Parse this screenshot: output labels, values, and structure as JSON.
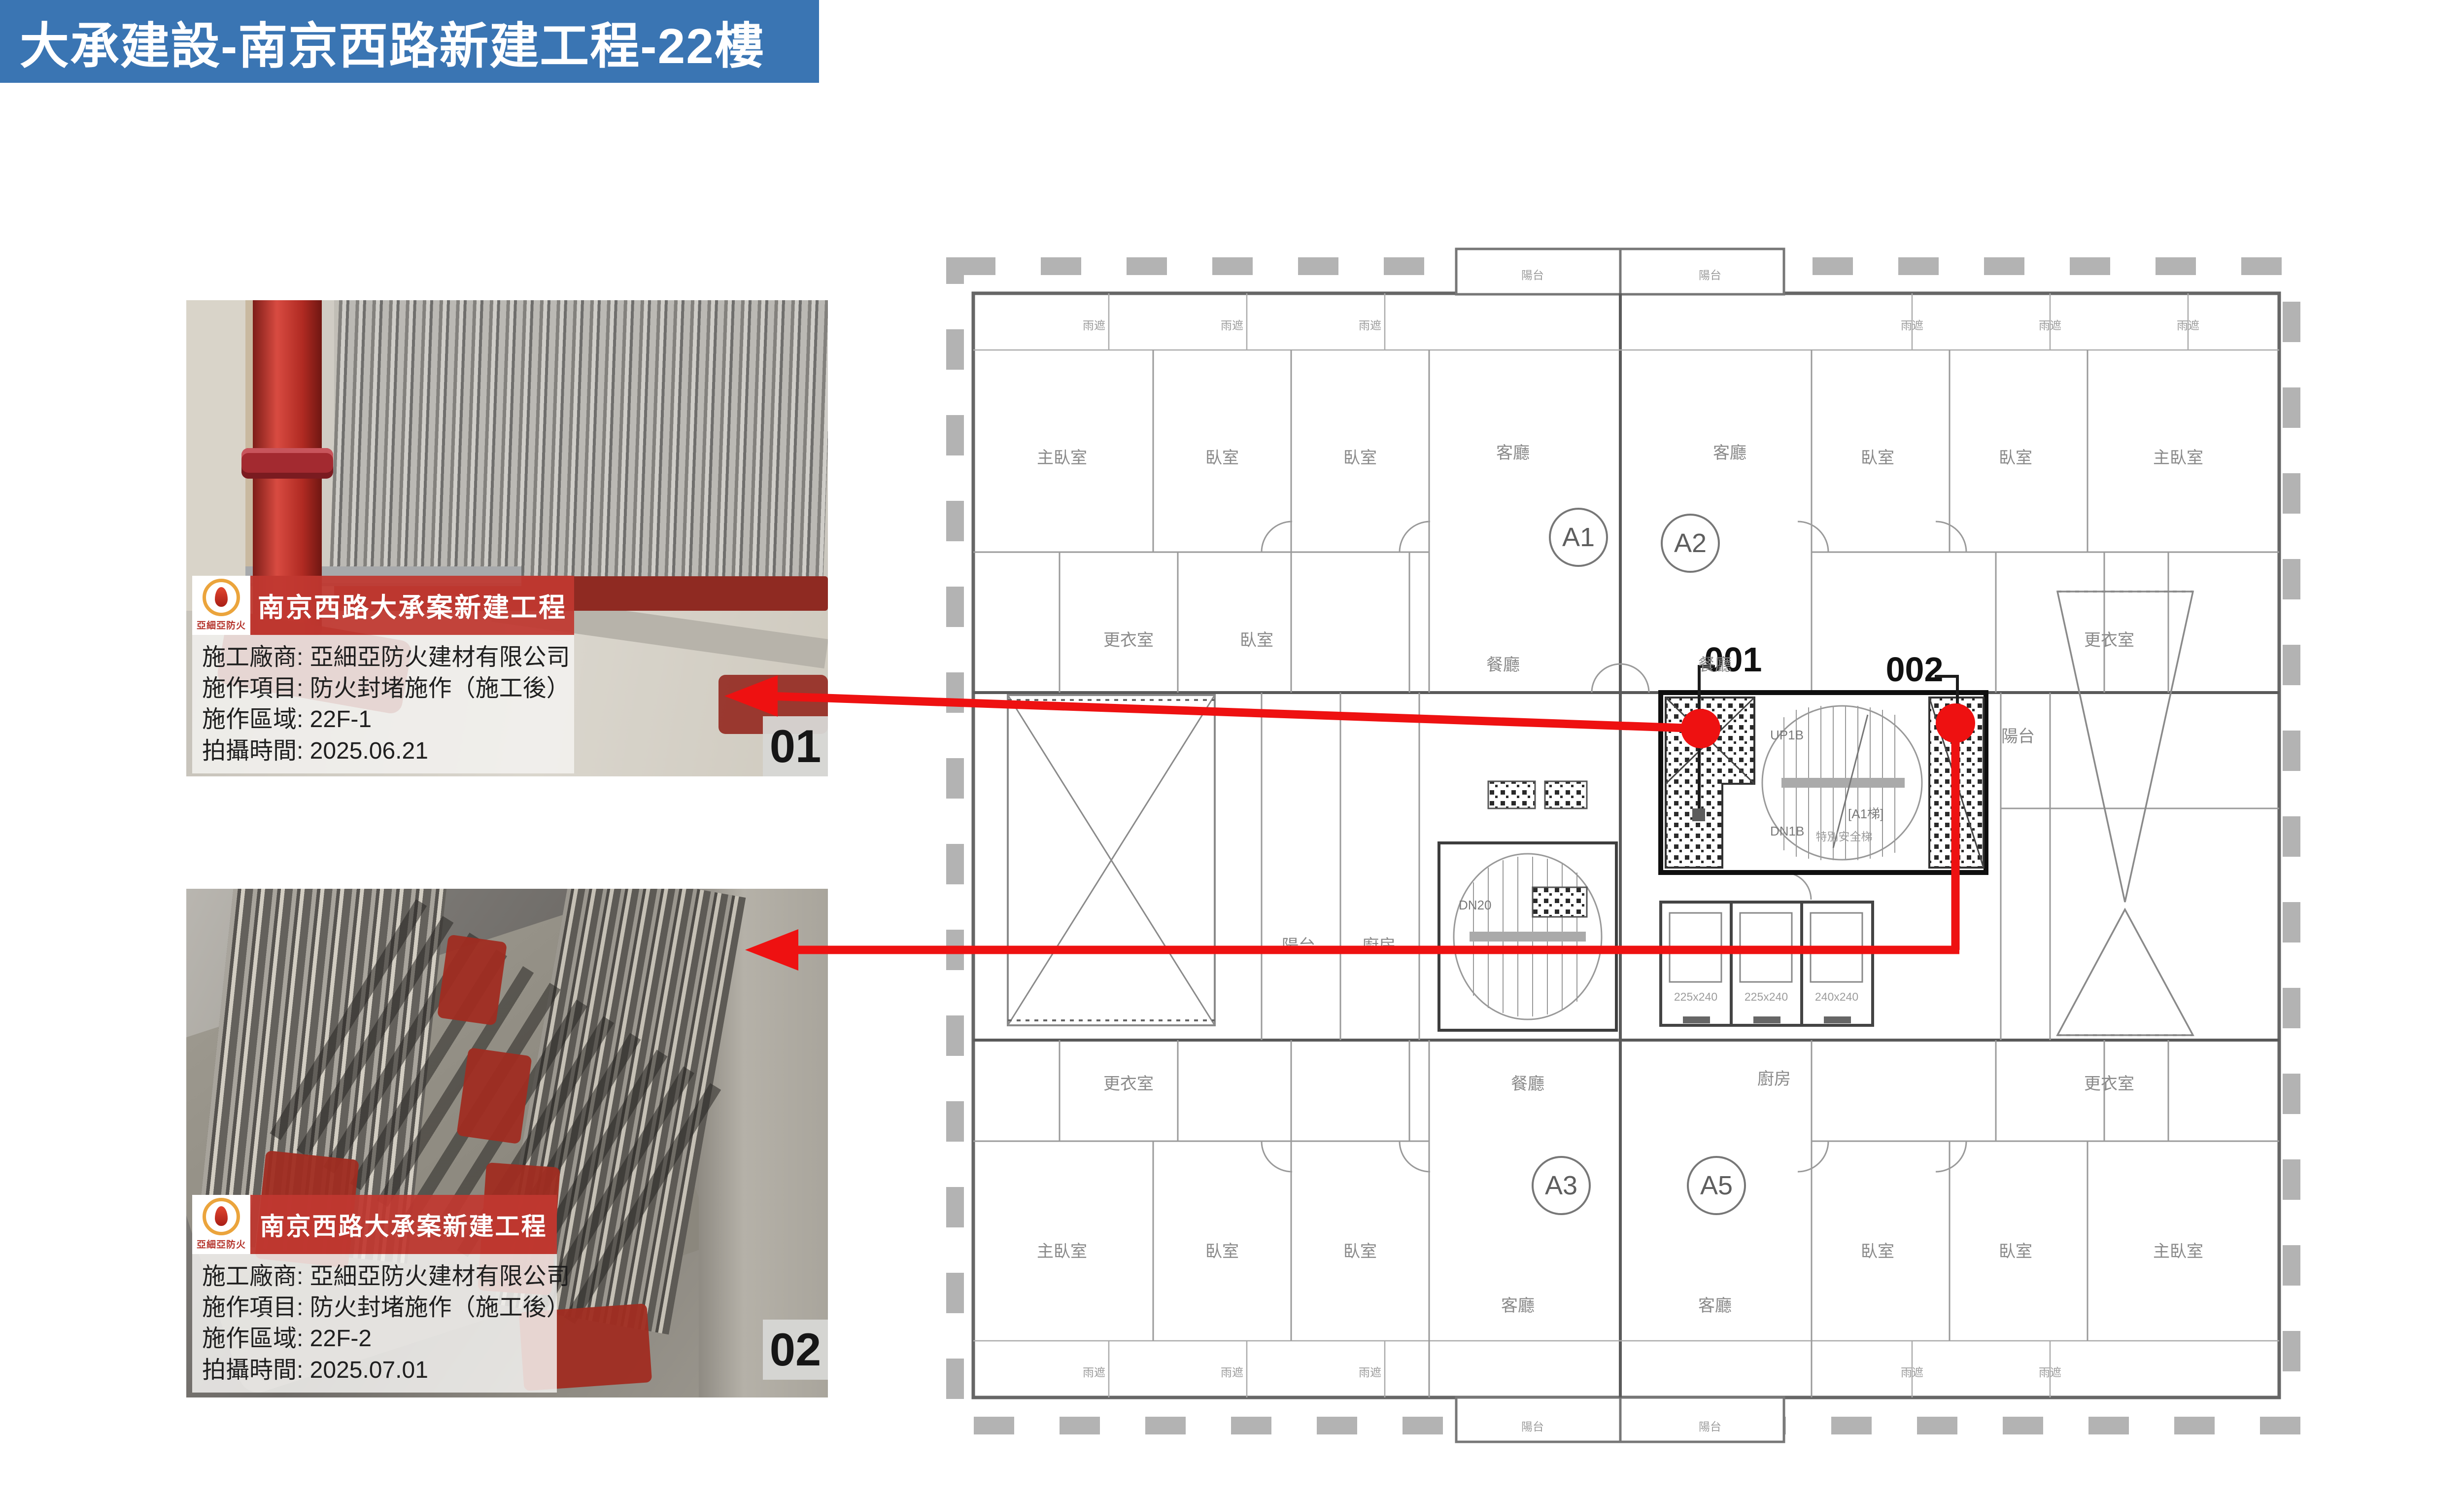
{
  "banner": {
    "text": "大承建設-南京西路新建工程-22樓"
  },
  "photos": [
    {
      "badge": "01",
      "tag": {
        "brand": "亞細亞防火",
        "title": "南京西路大承案新建工程",
        "rows": [
          "施工廠商: 亞細亞防火建材有限公司",
          "施作項目: 防火封堵施作（施工後）",
          "施作區域: 22F-1",
          "拍攝時間: 2025.06.21"
        ]
      }
    },
    {
      "badge": "02",
      "tag": {
        "brand": "亞細亞防火",
        "title": "南京西路大承案新建工程",
        "rows": [
          "施工廠商: 亞細亞防火建材有限公司",
          "施作項目: 防火封堵施作（施工後）",
          "施作區域: 22F-2",
          "拍攝時間: 2025.07.01"
        ]
      }
    }
  ],
  "plan": {
    "units": {
      "a1": "A1",
      "a2": "A2",
      "a3": "A3",
      "a5": "A5"
    },
    "markers": {
      "m1": "001",
      "m2": "002"
    },
    "stairs": {
      "up1b": "UP1B",
      "dn1b": "DN1B",
      "a1_stair": "[A1梯]",
      "stair_note": "特別安全梯",
      "dn20": "DN20",
      "up20": "UP20"
    },
    "elevators": [
      "225x240",
      "225x240",
      "240x240"
    ],
    "rooms": {
      "master": "主臥室",
      "bed": "臥室",
      "living": "客廳",
      "dining": "餐廳",
      "balcony": "陽台",
      "kitchen": "廚房",
      "dressing": "更衣室",
      "canopy": "雨遮"
    }
  },
  "colors": {
    "banner_bg": "#3a75b3",
    "tag_red": "#c1382f",
    "arrow_red": "#ee1111",
    "fireproof_red": "#8f2a22"
  }
}
